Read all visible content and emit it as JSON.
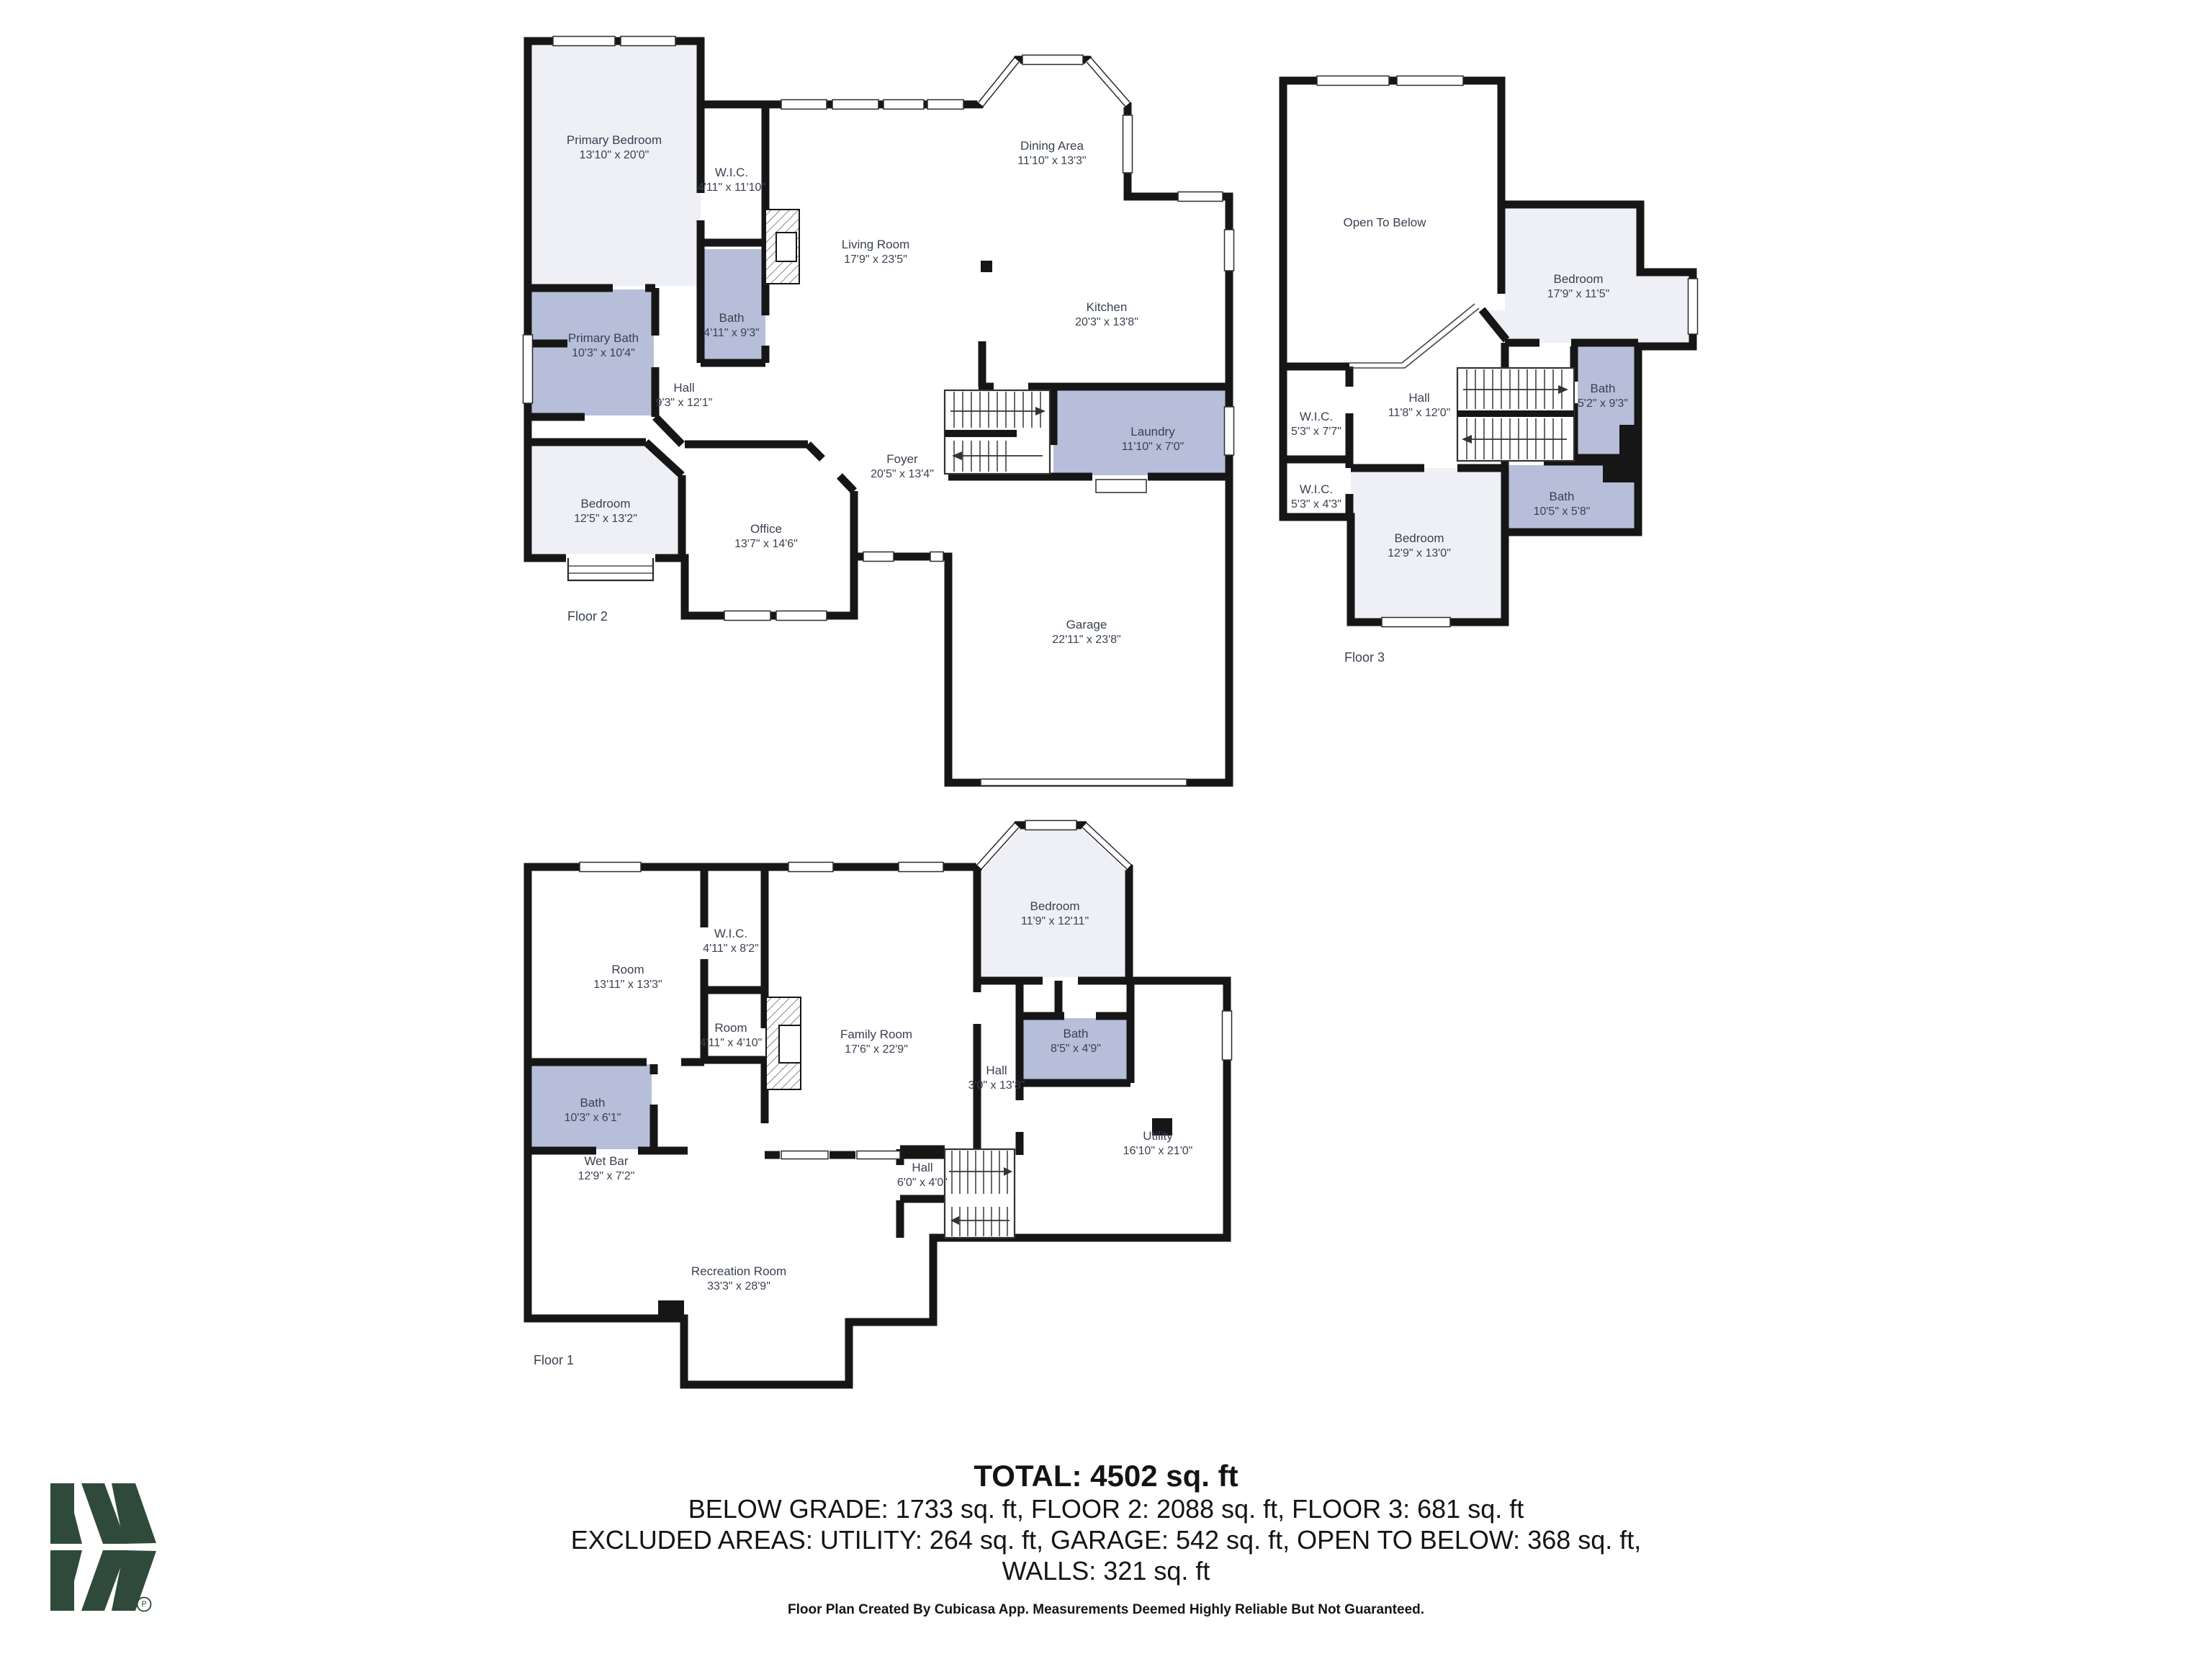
{
  "summary": {
    "total": "TOTAL: 4502 sq. ft",
    "breakdown": "BELOW GRADE: 1733 sq. ft, FLOOR 2: 2088 sq. ft, FLOOR 3: 681 sq. ft",
    "excluded": "EXCLUDED AREAS: UTILITY: 264 sq. ft, GARAGE: 542 sq. ft, OPEN TO BELOW: 368 sq. ft,",
    "walls": "WALLS: 321 sq. ft",
    "footer": "Floor Plan Created By Cubicasa App. Measurements Deemed Highly Reliable But Not Guaranteed."
  },
  "colors": {
    "wall": "#161616",
    "room_light": "#eef0f6",
    "room_highlight": "#b6bed9",
    "label_text": "#3a4150",
    "logo_green": "#2f4a3a"
  },
  "logo": {
    "name": "cubicasa-mw-logo",
    "mark": "P"
  },
  "floors": [
    {
      "id": "floor-2",
      "label": "Floor 2",
      "rooms": [
        {
          "name": "Primary Bedroom",
          "dims": "13'10\" x 20'0\""
        },
        {
          "name": "W.I.C.",
          "dims": "4'11\" x 11'10\""
        },
        {
          "name": "Bath",
          "dims": "4'11\" x 9'3\""
        },
        {
          "name": "Primary Bath",
          "dims": "10'3\" x 10'4\""
        },
        {
          "name": "Hall",
          "dims": "9'3\" x 12'1\""
        },
        {
          "name": "Bedroom",
          "dims": "12'5\" x 13'2\""
        },
        {
          "name": "Office",
          "dims": "13'7\" x 14'6\""
        },
        {
          "name": "Foyer",
          "dims": "20'5\" x 13'4\""
        },
        {
          "name": "Living Room",
          "dims": "17'9\" x 23'5\""
        },
        {
          "name": "Dining Area",
          "dims": "11'10\" x 13'3\""
        },
        {
          "name": "Kitchen",
          "dims": "20'3\" x 13'8\""
        },
        {
          "name": "Laundry",
          "dims": "11'10\" x 7'0\""
        },
        {
          "name": "Garage",
          "dims": "22'11\" x 23'8\""
        }
      ]
    },
    {
      "id": "floor-3",
      "label": "Floor 3",
      "rooms": [
        {
          "name": "Open To Below",
          "dims": ""
        },
        {
          "name": "Bedroom",
          "dims": "17'9\" x 11'5\""
        },
        {
          "name": "Hall",
          "dims": "11'8\" x 12'0\""
        },
        {
          "name": "W.I.C.",
          "dims": "5'3\" x 7'7\""
        },
        {
          "name": "W.I.C.",
          "dims": "5'3\" x 4'3\""
        },
        {
          "name": "Bath",
          "dims": "5'2\" x 9'3\""
        },
        {
          "name": "Bath",
          "dims": "10'5\" x 5'8\""
        },
        {
          "name": "Bedroom",
          "dims": "12'9\" x 13'0\""
        }
      ]
    },
    {
      "id": "floor-1",
      "label": "Floor 1",
      "rooms": [
        {
          "name": "Room",
          "dims": "13'11\" x 13'3\""
        },
        {
          "name": "W.I.C.",
          "dims": "4'11\" x 8'2\""
        },
        {
          "name": "Room",
          "dims": "4'11\" x 4'10\""
        },
        {
          "name": "Family Room",
          "dims": "17'6\" x 22'9\""
        },
        {
          "name": "Bedroom",
          "dims": "11'9\" x 12'11\""
        },
        {
          "name": "Bath",
          "dims": "10'3\" x 6'1\""
        },
        {
          "name": "Hall",
          "dims": "3'0\" x 13'8\""
        },
        {
          "name": "Bath",
          "dims": "8'5\" x 4'9\""
        },
        {
          "name": "Wet Bar",
          "dims": "12'9\" x 7'2\""
        },
        {
          "name": "Hall",
          "dims": "6'0\" x 4'0\""
        },
        {
          "name": "Utility",
          "dims": "16'10\" x 21'0\""
        },
        {
          "name": "Recreation Room",
          "dims": "33'3\" x 28'9\""
        }
      ]
    }
  ]
}
